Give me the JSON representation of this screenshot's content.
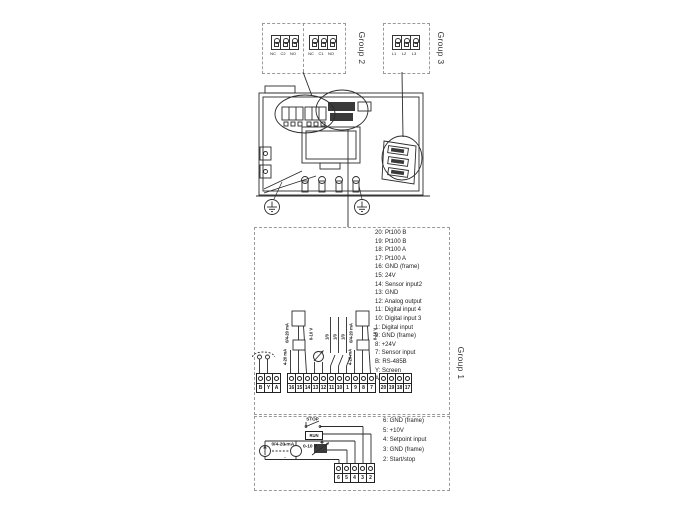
{
  "groups": {
    "g1": "Group 1",
    "g2": "Group 2",
    "g3": "Group 3"
  },
  "relay_connectors": {
    "left_pins": [
      "NC",
      "C2",
      "NO"
    ],
    "right_pins": [
      "NC",
      "C1",
      "NO"
    ]
  },
  "mains_connector": {
    "pins": [
      "L1",
      "L2",
      "L3"
    ]
  },
  "group1": {
    "terminal_list": [
      "20: Pt100 B",
      "19: Pt100 B",
      "18: Pt100 A",
      "17: Pt100 A",
      "16: GND (frame)",
      "15: 24V",
      "14: Sensor input2",
      "13: GND",
      "12: Analog output",
      "11: Digital input 4",
      "10: Digital input 3",
      "1: Digital input",
      "9: GND (frame)",
      "8: +24V",
      "7: Sensor input",
      "B: RS-485B",
      "Y: Screen",
      "A: RS-485A"
    ],
    "bus_terminals": [
      "B",
      "Y",
      "A"
    ],
    "io_terminals": [
      "16",
      "15",
      "14",
      "13",
      "12",
      "11",
      "10",
      "1",
      "9",
      "8",
      "7"
    ],
    "pt100_terminals": [
      "20",
      "19",
      "18",
      "17"
    ],
    "left_sensor": {
      "current_range": "0/4-20 mA",
      "voltage_range": "0-10 V",
      "loop_range": "4-20 mA"
    },
    "right_sensor": {
      "current_range": "0/4-20 mA",
      "voltage_range": "0-10 V",
      "loop_range": "4-20 mA"
    },
    "digital_switch_label": "1/0"
  },
  "setpoint": {
    "terminal_list": [
      "6: GND (frame)",
      "5: +10V",
      "4: Setpoint input",
      "3: GND (frame)",
      "2: Start/stop"
    ],
    "terminals": [
      "6",
      "5",
      "4",
      "3",
      "2"
    ],
    "current_source_label": "0/4-20 mA",
    "voltage_source_label": "0-10 V",
    "plus": "+",
    "minus": "-",
    "stop_label": "STOP",
    "run_label": "RUN"
  }
}
